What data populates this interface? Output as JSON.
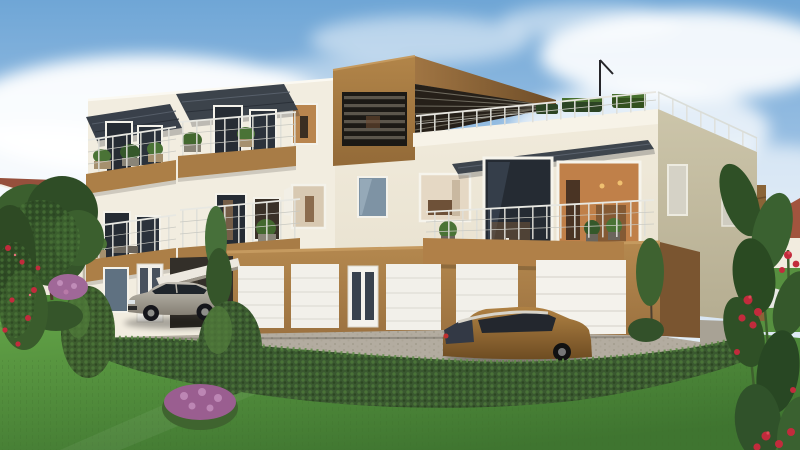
{
  "scene": {
    "type": "architectural-exterior-rendering",
    "description": "3D exterior rendering of a modern cream three-storey apartment building with caramel-brown accents: louvered penthouse, roof terrace with railing and planters, four balconies with plants and dark glass awnings, five white sectional garage doors, a carport with a silver sedan, a bronze estate car, cobbled driveway, clipped hedge, lawn, flowering shrubs and neighbouring red-roofed houses under a blue sky with clouds.",
    "objects": {
      "buildings": [
        "main apartment building",
        "red-roofed neighbour house left",
        "red-roofed neighbour house right with slatted fence"
      ],
      "vehicles": [
        "silver sedan parked at carport",
        "bronze estate car parked at garages"
      ],
      "vegetation": [
        "large green tree left",
        "clipped box hedge",
        "two round shrubs",
        "two slim trees",
        "purple flowering shrub",
        "red rose bush left",
        "red rose plant right",
        "roof terrace planters",
        "balcony plants"
      ],
      "building_features": [
        "penthouse with dark louver screen",
        "brown roof canopy",
        "roof terrace railing",
        "white parapet",
        "four front balconies with wire railings",
        "three dark window awnings",
        "five white sectional garage doors",
        "glazed entrance door",
        "white entry doors",
        "carport with white canopy",
        "rooftop antenna"
      ]
    },
    "counts": {
      "balconies_front": 4,
      "garage_doors": 5,
      "cars": 2,
      "window_awnings": 3,
      "roof_planters": 3
    }
  },
  "palette": {
    "sky_top": "#6FA6D6",
    "sky_mid": "#A9C9E8",
    "sky_horizon": "#EAF1F7",
    "cloud": "#FFFFFF",
    "wall_lit": "#F2EDE0",
    "wall_warm": "#EFE8D9",
    "wall_shaded": "#C7C0A4",
    "parapet": "#F7F3E8",
    "trim_white": "#F6F4EC",
    "accent_brown": "#A87C46",
    "accent_brown_dark": "#8A6234",
    "accent_brown_deep": "#7A5530",
    "balcony_brown": "#AC7F47",
    "louver_dark": "#1C1915",
    "louver_slat": "#5C564C",
    "awning": "#3C434B",
    "glass_dark": "#262C34",
    "glass_blue": "#7E93A4",
    "glass_warm": "#C08049",
    "interior_warm": "#D8C9B2",
    "garage_door": "#F2F0EA",
    "carport": "#332F29",
    "driveway": "#B3ACA0",
    "gravel": "#A8A295",
    "hedge": "#3A5830",
    "hedge_light": "#5E8C46",
    "lawn_light": "#61A146",
    "lawn_dark": "#3F7530",
    "tree_dark": "#2F4D26",
    "tree_mid": "#43682F",
    "roof_red": "#96503C",
    "fence_brown": "#8A6437",
    "house_wall": "#EFE9DC",
    "car_silver": "#ACA89E",
    "car_bronze": "#9A7034",
    "car_glass": "#23272E",
    "flower_red": "#C22B3C",
    "flower_purple": "#A06898",
    "railing": "#DEDED8",
    "rail_wire": "#C9C9C2"
  }
}
